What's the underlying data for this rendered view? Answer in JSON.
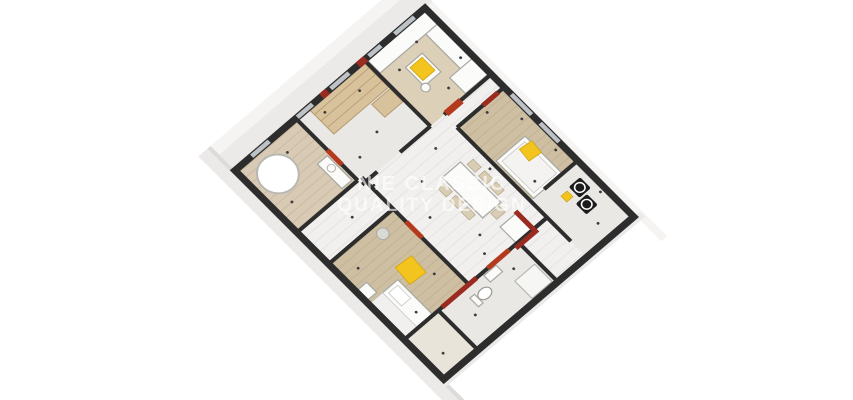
{
  "scene": {
    "description": "3D axonometric rendered floor plan of an apartment, rotated diamond orientation on white background",
    "watermark": {
      "line1": "NIE CLASSIC",
      "line2": "QUALITY DESIGN"
    }
  },
  "colors": {
    "bg": "#ffffff",
    "wall": "#2d2d2d",
    "wall-red": "#9a2b20",
    "red-bright": "#b43a1d",
    "window": "#bcc2c5",
    "slab": "#eceae8",
    "slab-light": "#f5f4f2",
    "slab-dark": "#dcdbd9",
    "floor-white": "#f1f0ee",
    "floor-tile": "#eae8e4",
    "floor-wood": "#cfbfa2",
    "floor-wood-light": "#ddd0b8",
    "floor-beige": "#d8cab4",
    "wardrobe": "#d8c29b",
    "accent-yellow": "#f2c41d",
    "appliance-black": "#1c1c1c",
    "furniture-white": "#fbfbfa",
    "furniture-stroke": "#a8a8a3",
    "chair-tan": "#d9cdb4",
    "watermark": "rgba(255,255,255,0.62)"
  }
}
